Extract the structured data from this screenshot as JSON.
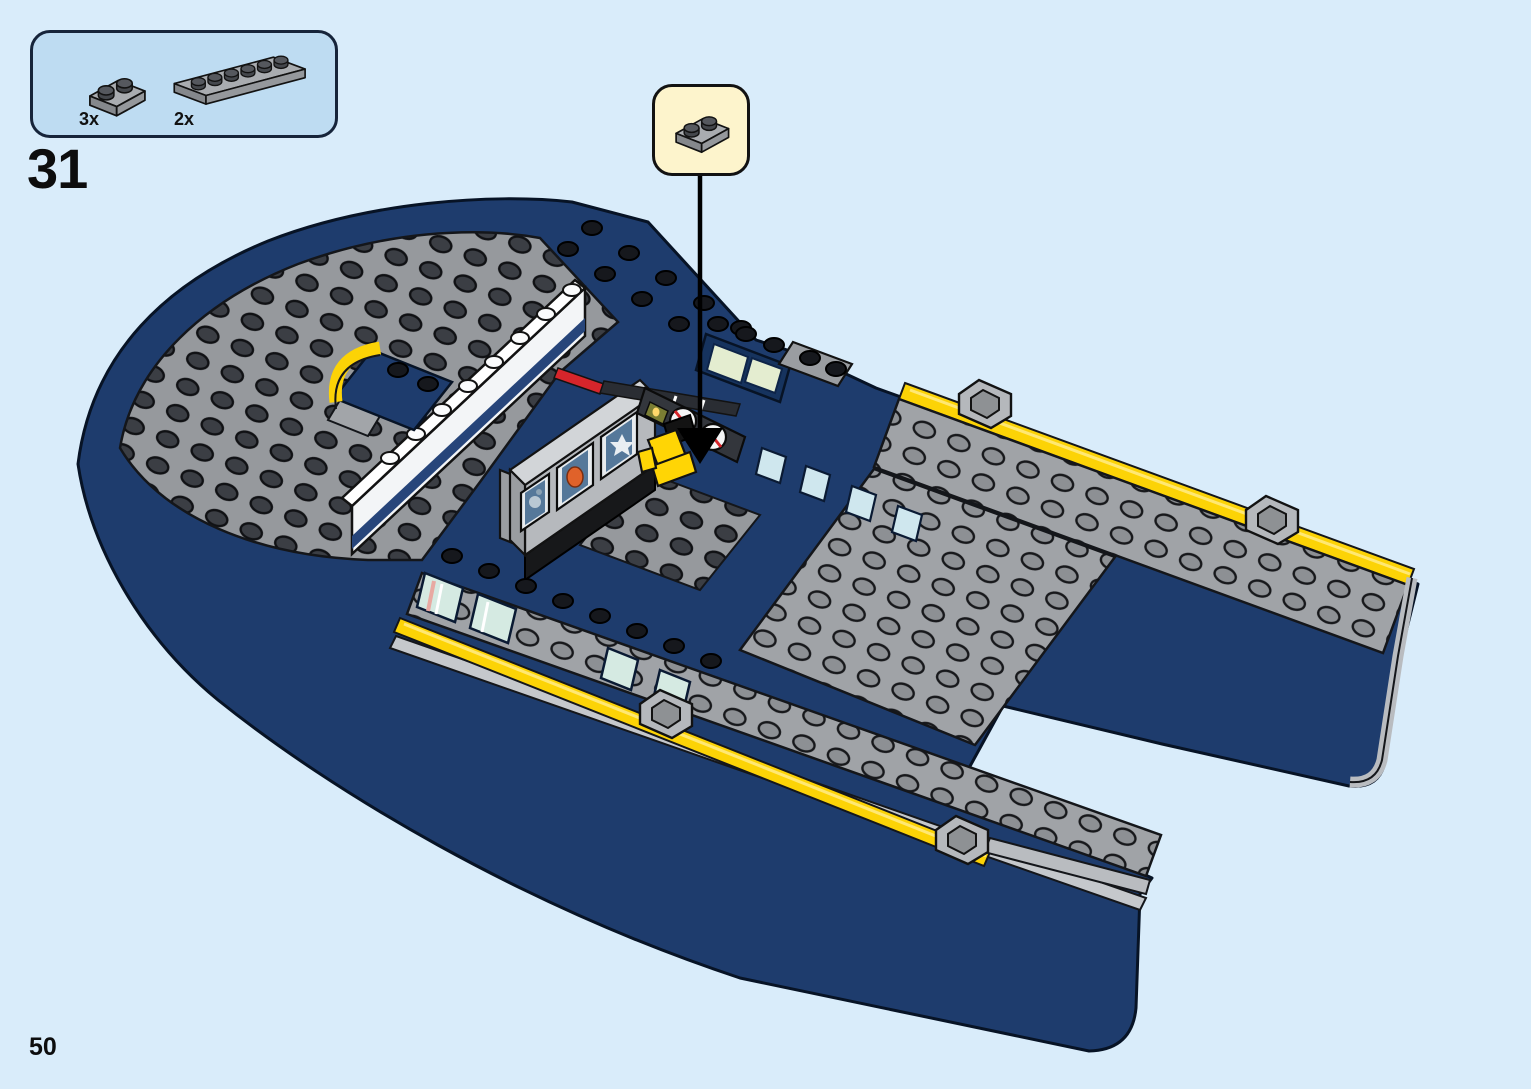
{
  "page": {
    "number": "50",
    "background_color": "#d9ecfa"
  },
  "step": {
    "number": "31"
  },
  "parts_box": {
    "items": [
      {
        "qty": "3x",
        "part": "dark-gray-plate-1x2"
      },
      {
        "qty": "2x",
        "part": "dark-gray-plate-1x6"
      }
    ]
  },
  "callout": {
    "part": "dark-gray-plate-1x2"
  },
  "illustration": {
    "alt": "Partially built LEGO ship hull seen from above-front; a black arrow points from the 1x2 plate callout down to the helm area beside the yellow pilot seat and gauge console"
  },
  "colors": {
    "panel_blue": "#bedcf2",
    "callout_yellow": "#fdf4cc",
    "hull_navy": "#1e3c6d",
    "deck_gray": "#a0a3a7",
    "stud_dark": "#393c42",
    "stripe_yellow": "#fcd306",
    "accent_red": "#d6252b",
    "wall_white": "#f3f5f7",
    "window_glass": "#d5eae2",
    "seat_yellow": "#ffd505"
  }
}
